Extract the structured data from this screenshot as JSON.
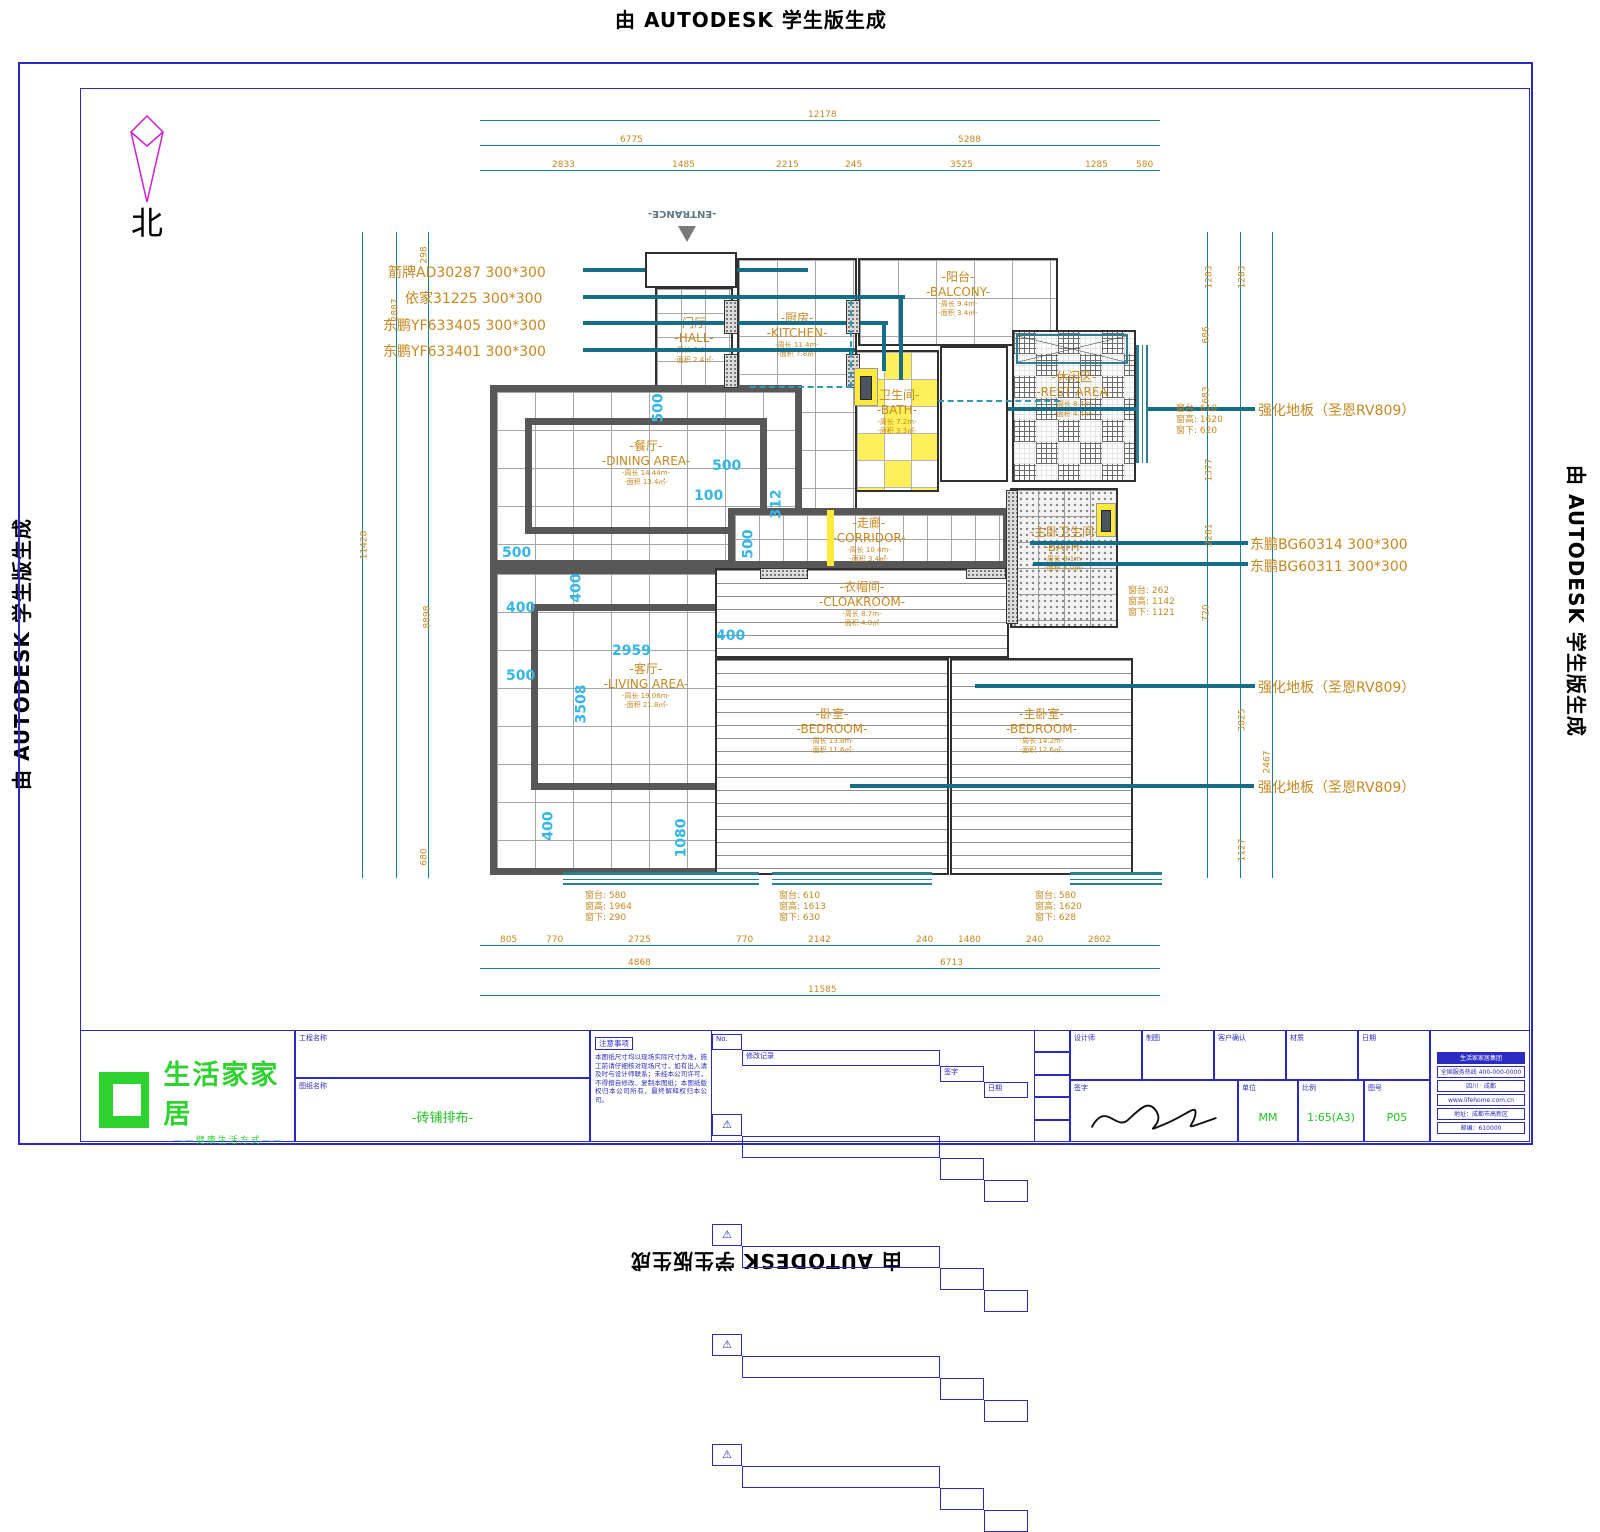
{
  "watermark": {
    "text": "由 AUTODESK 学生版生成"
  },
  "north": {
    "label": "北"
  },
  "entrance": {
    "label": "-ENTRANCE-"
  },
  "rooms": [
    {
      "id": "hall",
      "zh": "-门厅-",
      "en": "-HALL-",
      "l1": "-周长 8.4m-",
      "l2": "-面积 2.4㎡-",
      "x": 655,
      "y": 287,
      "w": 78,
      "h": 102,
      "f": "tile-sm",
      "wall": "thin",
      "ly": 28
    },
    {
      "id": "kitchen",
      "zh": "-厨房-",
      "en": "-KITCHEN-",
      "l1": "-周长 11.4m-",
      "l2": "-面积 7.8㎡-",
      "x": 737,
      "y": 258,
      "w": 120,
      "h": 260,
      "f": "tile",
      "wall": "thin",
      "ly": 20
    },
    {
      "id": "balcony",
      "zh": "-阳台-",
      "en": "-BALCONY-",
      "l1": "-周长 9.4m-",
      "l2": "-面积 3.4㎡-",
      "x": 858,
      "y": 258,
      "w": 200,
      "h": 88,
      "f": "tile",
      "wall": "thin",
      "ly": 12
    },
    {
      "id": "bath",
      "zh": "-卫生间-",
      "en": "-BATH-",
      "l1": "-周长 7.2m-",
      "l2": "-面积 3.3㎡-",
      "x": 855,
      "y": 350,
      "w": 84,
      "h": 142,
      "f": "yellow",
      "wall": "thin",
      "ly": 26
    },
    {
      "id": "rest-area",
      "zh": "-休闲区-",
      "en": "-REST AREA-",
      "l1": "-周长 8.4m-",
      "l2": "-面积 4.4㎡-",
      "x": 1012,
      "y": 330,
      "w": 124,
      "h": 152,
      "f": "parquet",
      "wall": "thin",
      "ly": 26
    },
    {
      "id": "master-bath",
      "zh": "-主卧卫生间-",
      "en": "-BATH-",
      "l1": "-周长 8.1m-",
      "l2": "-面积 4.0㎡-",
      "x": 1010,
      "y": 488,
      "w": 108,
      "h": 140,
      "f": "speckle",
      "wall": "thin",
      "ly": 26
    },
    {
      "id": "dining",
      "zh": "-餐厅-",
      "en": "-DINING AREA-",
      "l1": "-周长 14.44m-",
      "l2": "-面积 13.4㎡-",
      "x": 490,
      "y": 385,
      "w": 312,
      "h": 182,
      "f": "tile",
      "wall": "heavy",
      "inner": [
        28,
        26,
        28,
        26
      ],
      "ly": 28
    },
    {
      "id": "living",
      "zh": "-客厅-",
      "en": "-LIVING AREA-",
      "l1": "-周长 19.06m-",
      "l2": "-面积 21.8㎡-",
      "x": 490,
      "y": 567,
      "w": 312,
      "h": 308,
      "f": "tile",
      "wall": "heavy",
      "inner": [
        34,
        30,
        54,
        78
      ],
      "ly": 30
    },
    {
      "id": "corridor",
      "zh": "-走廊-",
      "en": "-CORRIDOR-",
      "l1": "-周长 10.4m-",
      "l2": "-面积 3.4㎡-",
      "x": 728,
      "y": 508,
      "w": 282,
      "h": 60,
      "f": "tile-sm",
      "wall": "heavy",
      "ly": 2
    },
    {
      "id": "cloakroom",
      "zh": "-衣帽间-",
      "en": "-CLOAKROOM-",
      "l1": "-周长 8.7m-",
      "l2": "-面积 4.0㎡-",
      "x": 715,
      "y": 568,
      "w": 294,
      "h": 90,
      "f": "plank",
      "wall": "thin",
      "ly": 12
    },
    {
      "id": "bedroom",
      "zh": "-卧室-",
      "en": "-BEDROOM-",
      "l1": "-周长 13.8m-",
      "l2": "-面积 11.6㎡-",
      "x": 715,
      "y": 658,
      "w": 234,
      "h": 217,
      "f": "plank",
      "wall": "thin",
      "ly": 22
    },
    {
      "id": "master-bedroom",
      "zh": "-主卧室-",
      "en": "-BEDROOM-",
      "l1": "-周长 14.2m-",
      "l2": "-面积 12.6㎡-",
      "x": 950,
      "y": 658,
      "w": 183,
      "h": 217,
      "f": "plank",
      "wall": "thin",
      "ly": 22
    }
  ],
  "shapes": [
    {
      "c": "dl-h",
      "x": 480,
      "y": 120,
      "w": 680,
      "h": 1
    },
    {
      "c": "dl-h",
      "x": 480,
      "y": 145,
      "w": 680,
      "h": 1
    },
    {
      "c": "dl-h",
      "x": 480,
      "y": 170,
      "w": 680,
      "h": 1
    },
    {
      "c": "dl-h",
      "x": 480,
      "y": 945,
      "w": 680,
      "h": 1
    },
    {
      "c": "dl-h",
      "x": 480,
      "y": 968,
      "w": 680,
      "h": 1
    },
    {
      "c": "dl-h",
      "x": 480,
      "y": 995,
      "w": 680,
      "h": 1
    },
    {
      "c": "dl-v",
      "x": 362,
      "y": 232,
      "w": 1,
      "h": 646
    },
    {
      "c": "dl-v",
      "x": 396,
      "y": 232,
      "w": 1,
      "h": 646
    },
    {
      "c": "dl-v",
      "x": 428,
      "y": 232,
      "w": 1,
      "h": 646
    },
    {
      "c": "dl-v",
      "x": 1207,
      "y": 232,
      "w": 1,
      "h": 646
    },
    {
      "c": "dl-v",
      "x": 1240,
      "y": 232,
      "w": 1,
      "h": 646
    },
    {
      "c": "dl-v",
      "x": 1272,
      "y": 232,
      "w": 1,
      "h": 646
    },
    {
      "c": "ld",
      "x": 583,
      "y": 268,
      "w": 225,
      "h": 4
    },
    {
      "c": "ld",
      "x": 583,
      "y": 295,
      "w": 322,
      "h": 4
    },
    {
      "c": "ld",
      "x": 583,
      "y": 321,
      "w": 305,
      "h": 4
    },
    {
      "c": "ld",
      "x": 583,
      "y": 348,
      "w": 272,
      "h": 4
    },
    {
      "c": "ld",
      "x": 975,
      "y": 407,
      "w": 280,
      "h": 4
    },
    {
      "c": "ld",
      "x": 1030,
      "y": 541,
      "w": 218,
      "h": 4
    },
    {
      "c": "ld",
      "x": 1033,
      "y": 562,
      "w": 215,
      "h": 4
    },
    {
      "c": "ld",
      "x": 975,
      "y": 684,
      "w": 280,
      "h": 4
    },
    {
      "c": "ld",
      "x": 850,
      "y": 784,
      "w": 404,
      "h": 4
    },
    {
      "c": "ldv",
      "x": 899,
      "y": 295,
      "w": 4,
      "h": 85
    },
    {
      "c": "ldv",
      "x": 882,
      "y": 321,
      "w": 4,
      "h": 50
    },
    {
      "c": "ldv",
      "x": 849,
      "y": 348,
      "w": 4,
      "h": 26
    },
    {
      "c": "f-plank rb",
      "x": 940,
      "y": 346,
      "w": 68,
      "h": 136
    },
    {
      "c": "rb",
      "x": 645,
      "y": 252,
      "w": 92,
      "h": 36
    },
    {
      "c": "pier",
      "x": 724,
      "y": 300,
      "w": 14,
      "h": 34
    },
    {
      "c": "pier",
      "x": 724,
      "y": 354,
      "w": 14,
      "h": 34
    },
    {
      "c": "pier",
      "x": 846,
      "y": 300,
      "w": 14,
      "h": 34
    },
    {
      "c": "pier",
      "x": 846,
      "y": 354,
      "w": 14,
      "h": 34
    },
    {
      "c": "pier",
      "x": 760,
      "y": 568,
      "w": 48,
      "h": 11
    },
    {
      "c": "pier",
      "x": 966,
      "y": 568,
      "w": 40,
      "h": 11
    },
    {
      "c": "pier",
      "x": 1006,
      "y": 490,
      "w": 12,
      "h": 134
    },
    {
      "c": "win",
      "x": 563,
      "y": 872,
      "w": 196,
      "h": 13
    },
    {
      "c": "win",
      "x": 772,
      "y": 872,
      "w": 160,
      "h": 13
    },
    {
      "c": "win",
      "x": 1070,
      "y": 872,
      "w": 92,
      "h": 13
    },
    {
      "c": "winv",
      "x": 1136,
      "y": 345,
      "w": 12,
      "h": 118
    },
    {
      "c": "ystrip",
      "x": 827,
      "y": 510,
      "w": 7,
      "h": 56
    },
    {
      "c": "ydoor",
      "x": 854,
      "y": 368,
      "w": 24,
      "h": 38
    },
    {
      "c": "ydoor",
      "x": 1096,
      "y": 503,
      "w": 20,
      "h": 34
    },
    {
      "c": "dk",
      "x": 860,
      "y": 376,
      "w": 12,
      "h": 24
    },
    {
      "c": "dk",
      "x": 1101,
      "y": 510,
      "w": 10,
      "h": 22
    },
    {
      "c": "dashbr",
      "x": 750,
      "y": 300,
      "w": 102,
      "h": 88
    },
    {
      "c": "dashh",
      "x": 938,
      "y": 400,
      "w": 122,
      "h": 2
    },
    {
      "c": "xbox",
      "x": 1016,
      "y": 334,
      "w": 112,
      "h": 30
    }
  ],
  "texts": [
    {
      "c": "spec",
      "t": "箭牌AD30287  300*300",
      "x": 388,
      "y": 262,
      "n": "tile-spec-1"
    },
    {
      "c": "spec",
      "t": "依家31225  300*300",
      "x": 405,
      "y": 288,
      "n": "tile-spec-2"
    },
    {
      "c": "spec",
      "t": "东鹏YF633405  300*300",
      "x": 383,
      "y": 315,
      "n": "tile-spec-3"
    },
    {
      "c": "spec",
      "t": "东鹏YF633401  300*300",
      "x": 383,
      "y": 341,
      "n": "tile-spec-4"
    },
    {
      "c": "spec",
      "t": "强化地板（圣恩RV809）",
      "x": 1258,
      "y": 400,
      "n": "floor-spec-1"
    },
    {
      "c": "spec",
      "t": "东鹏BG60314  300*300",
      "x": 1250,
      "y": 534,
      "n": "tile-spec-5"
    },
    {
      "c": "spec",
      "t": "东鹏BG60311  300*300",
      "x": 1250,
      "y": 556,
      "n": "tile-spec-6"
    },
    {
      "c": "spec",
      "t": "强化地板（圣恩RV809）",
      "x": 1258,
      "y": 677,
      "n": "floor-spec-2"
    },
    {
      "c": "spec",
      "t": "强化地板（圣恩RV809）",
      "x": 1258,
      "y": 777,
      "n": "floor-spec-3"
    },
    {
      "c": "dim",
      "t": "12178",
      "x": 808,
      "y": 110
    },
    {
      "c": "dim",
      "t": "6775",
      "x": 620,
      "y": 135
    },
    {
      "c": "dim",
      "t": "5288",
      "x": 958,
      "y": 135
    },
    {
      "c": "dim",
      "t": "2833",
      "x": 552,
      "y": 160
    },
    {
      "c": "dim",
      "t": "1485",
      "x": 672,
      "y": 160
    },
    {
      "c": "dim",
      "t": "2215",
      "x": 776,
      "y": 160
    },
    {
      "c": "dim",
      "t": "245",
      "x": 845,
      "y": 160
    },
    {
      "c": "dim",
      "t": "3525",
      "x": 950,
      "y": 160
    },
    {
      "c": "dim",
      "t": "1285",
      "x": 1085,
      "y": 160
    },
    {
      "c": "dim",
      "t": "580",
      "x": 1136,
      "y": 160
    },
    {
      "c": "dim",
      "t": "11428",
      "x": 350,
      "y": 540,
      "r": 1
    },
    {
      "c": "dim",
      "t": "2887",
      "x": 384,
      "y": 305,
      "r": 1
    },
    {
      "c": "dim",
      "t": "8898",
      "x": 416,
      "y": 612,
      "r": 1
    },
    {
      "c": "dim",
      "t": "298",
      "x": 416,
      "y": 250,
      "r": 1
    },
    {
      "c": "dim",
      "t": "680",
      "x": 416,
      "y": 852,
      "r": 1
    },
    {
      "c": "dim",
      "t": "1283",
      "x": 1198,
      "y": 272,
      "r": 1
    },
    {
      "c": "dim",
      "t": "1283",
      "x": 1231,
      "y": 272,
      "r": 1
    },
    {
      "c": "dim",
      "t": "686",
      "x": 1198,
      "y": 330,
      "r": 1
    },
    {
      "c": "dim",
      "t": "683",
      "x": 1198,
      "y": 390,
      "r": 1
    },
    {
      "c": "dim",
      "t": "1377",
      "x": 1198,
      "y": 465,
      "r": 1
    },
    {
      "c": "dim",
      "t": "2281",
      "x": 1198,
      "y": 530,
      "r": 1
    },
    {
      "c": "dim",
      "t": "720",
      "x": 1198,
      "y": 608,
      "r": 1
    },
    {
      "c": "dim",
      "t": "3825",
      "x": 1231,
      "y": 715,
      "r": 1
    },
    {
      "c": "dim",
      "t": "2467",
      "x": 1256,
      "y": 757,
      "r": 1
    },
    {
      "c": "dim",
      "t": "1127",
      "x": 1231,
      "y": 845,
      "r": 1
    },
    {
      "c": "dim",
      "t": "805",
      "x": 500,
      "y": 935
    },
    {
      "c": "dim",
      "t": "770",
      "x": 546,
      "y": 935
    },
    {
      "c": "dim",
      "t": "2725",
      "x": 628,
      "y": 935
    },
    {
      "c": "dim",
      "t": "770",
      "x": 736,
      "y": 935
    },
    {
      "c": "dim",
      "t": "2142",
      "x": 808,
      "y": 935
    },
    {
      "c": "dim",
      "t": "240",
      "x": 916,
      "y": 935
    },
    {
      "c": "dim",
      "t": "1480",
      "x": 958,
      "y": 935
    },
    {
      "c": "dim",
      "t": "240",
      "x": 1026,
      "y": 935
    },
    {
      "c": "dim",
      "t": "2802",
      "x": 1088,
      "y": 935
    },
    {
      "c": "dim",
      "t": "4868",
      "x": 628,
      "y": 958
    },
    {
      "c": "dim",
      "t": "6713",
      "x": 940,
      "y": 958
    },
    {
      "c": "dim",
      "t": "11585",
      "x": 808,
      "y": 985
    },
    {
      "c": "cy",
      "t": "500",
      "x": 644,
      "y": 400,
      "r": 1
    },
    {
      "c": "cy",
      "t": "500",
      "x": 712,
      "y": 458
    },
    {
      "c": "cy",
      "t": "100",
      "x": 694,
      "y": 488
    },
    {
      "c": "cy",
      "t": "312",
      "x": 762,
      "y": 496,
      "r": 1
    },
    {
      "c": "cy",
      "t": "500",
      "x": 502,
      "y": 545
    },
    {
      "c": "cy",
      "t": "500",
      "x": 734,
      "y": 536,
      "r": 1
    },
    {
      "c": "cy",
      "t": "400",
      "x": 562,
      "y": 580,
      "r": 1
    },
    {
      "c": "cy",
      "t": "400",
      "x": 506,
      "y": 600
    },
    {
      "c": "cy",
      "t": "400",
      "x": 716,
      "y": 628
    },
    {
      "c": "cy",
      "t": "2959",
      "x": 612,
      "y": 643
    },
    {
      "c": "cy",
      "t": "500",
      "x": 506,
      "y": 668
    },
    {
      "c": "cy",
      "t": "3508",
      "x": 562,
      "y": 696,
      "r": 1
    },
    {
      "c": "cy",
      "t": "400",
      "x": 534,
      "y": 818,
      "r": 1
    },
    {
      "c": "cy",
      "t": "1080",
      "x": 662,
      "y": 830,
      "r": 1
    }
  ],
  "windows": [
    {
      "x": 585,
      "y": 891,
      "lines": [
        "窗台: 580",
        "窗高: 1964",
        "窗下: 290"
      ]
    },
    {
      "x": 779,
      "y": 891,
      "lines": [
        "窗台: 610",
        "窗高: 1613",
        "窗下: 630"
      ]
    },
    {
      "x": 1035,
      "y": 891,
      "lines": [
        "窗台: 580",
        "窗高: 1620",
        "窗下: 628"
      ]
    },
    {
      "x": 1176,
      "y": 404,
      "lines": [
        "窗台: 610",
        "窗高: 1620",
        "窗下: 620"
      ]
    },
    {
      "x": 1128,
      "y": 586,
      "lines": [
        "窗台: 262",
        "窗高: 1142",
        "窗下: 1121"
      ]
    }
  ],
  "titleblock": {
    "logo": {
      "name": "生活家家居",
      "tagline": "——健康生活方式——"
    },
    "project_label": "工程名称",
    "drawing_label": "图纸名称",
    "drawing_name": "-砖铺排布-",
    "notes": {
      "header": "注意事项",
      "body": "本图纸尺寸均以现场实际尺寸为准，施工前请仔细核对现场尺寸，如有出入请及时与设计师联系；未经本公司许可，不得擅自修改、复制本图纸；本图纸版权归本公司所有，最终解释权归本公司。"
    },
    "revision": {
      "headers": [
        "No.",
        "修改记录",
        "签字",
        "日期"
      ],
      "row_count": 4
    },
    "personnel": {
      "top_labels": [
        "设计师",
        "制图",
        "客户确认",
        "材质",
        "日期"
      ],
      "sign_label": "签字",
      "unit_label": "单位",
      "unit_value": "MM",
      "scale_label": "比例",
      "scale_value": "1:65(A3)",
      "sheet_label": "图号",
      "sheet_value": "P05"
    },
    "stamp_lines": [
      "生活家家居集团",
      "全国服务热线 400-000-0000",
      "四川 · 成都",
      "www.lifehome.com.cn",
      "地址：成都市高新区",
      "邮编：610000"
    ]
  }
}
